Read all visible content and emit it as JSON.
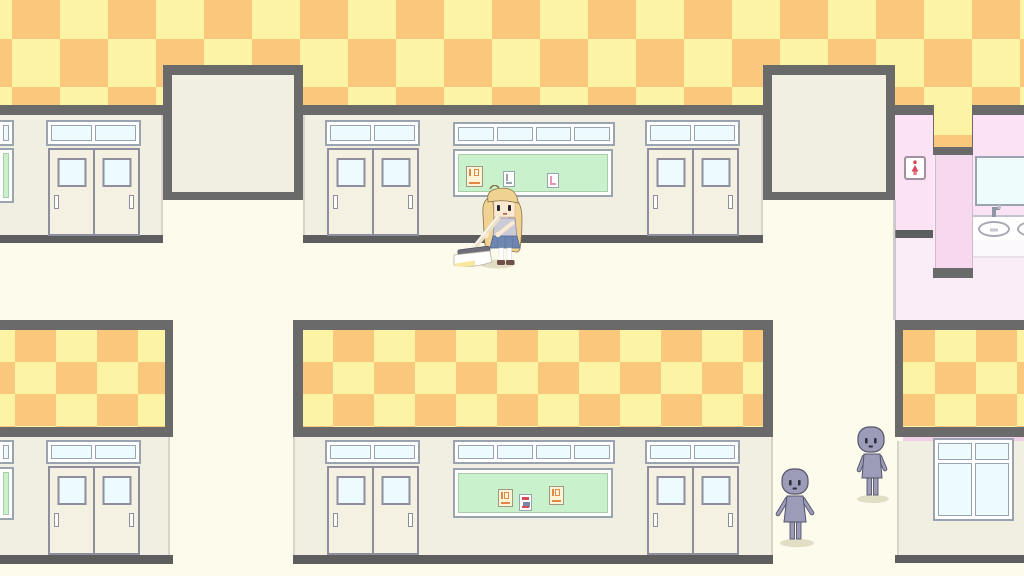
{
  "scene": {
    "title": "School hallway — pixel RPG scene",
    "description": "Overhead pixel-art school corridor: orange-and-yellow checkerboard upper walls, cream walls with sliding double doors, transom windows and green bulletin boards with small posters, a pink girls' restroom area on the right with sign, mirror and sink counter, a blonde student sweeping the floor with a broom in the center, and two featureless gray students standing in the lower-right corridor.",
    "visible_text": "none"
  },
  "colors": {
    "checker_orange": "#FAC87D",
    "checker_yellow": "#FDF3A4",
    "border_gray": "#6A6A6A",
    "baseboard_gray": "#5E5E5E",
    "wall_cream": "#F1EFE2",
    "floor_cream": "#FDFCEC",
    "door_cream": "#F4F1E3",
    "door_outline": "#8E8E9E",
    "frame_white": "#FFFFFF",
    "frame_outline": "#9AA4B0",
    "glass_blue": "#EDFAFE",
    "board_green": "#C9F2CC",
    "poster_cream": "#FCF4D4",
    "poster_mark_orange": "#E08848",
    "poster_mark_red": "#D84A55",
    "poster_mark_gray": "#98A0AA",
    "poster_mark_pink": "#E598B4",
    "pink_wall": "#FBE3F5",
    "pink_pillar": "#F6D9EF",
    "pink_floor": "#FBEDF8",
    "pink_accent": "#F0D0E8",
    "mirror_cyan": "#EFFCFC",
    "sign_red": "#E0485A",
    "npc_body": "#9C9CB9",
    "npc_outline": "#54546B",
    "npc_face": "#2E2E3E",
    "girl_hair": "#F0D392",
    "girl_hair_outline": "#8A7148",
    "girl_skin": "#FBE9D2",
    "girl_vest": "#CBCBD8",
    "girl_vest_outline": "#8F8FA0",
    "girl_skirt": "#6E87B2",
    "girl_skirt_outline": "#50678E",
    "girl_shoe": "#6F4F48",
    "broom_wood": "#EAE1C7",
    "broom_head": "#6F6F7B",
    "broom_shine": "#F8E89E",
    "shadow": "#E2DEC6"
  },
  "entities": {
    "player": {
      "label": "blonde student sweeping the floor with a broom"
    },
    "npc_front": {
      "label": "gray student facing forward"
    },
    "npc_side": {
      "label": "gray student standing"
    },
    "restroom_sign": {
      "label": "women's restroom sign"
    },
    "door": {
      "label": "sliding classroom double door"
    },
    "board": {
      "label": "green bulletin board with posters"
    }
  }
}
